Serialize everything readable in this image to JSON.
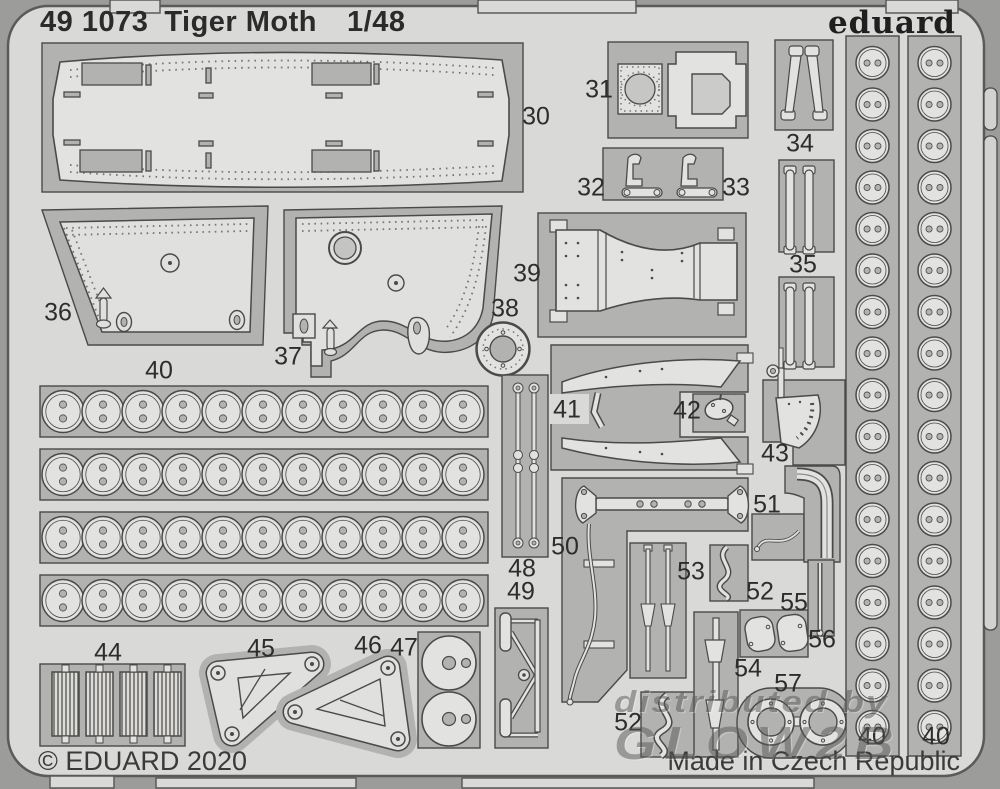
{
  "header": {
    "catalog_number": "49 1073",
    "product_title": "Tiger Moth",
    "scale": "1/48",
    "brand_logo": "eduard"
  },
  "footer": {
    "copyright": "© EDUARD 2020",
    "made_in": "Made in Czech Republic"
  },
  "watermark": {
    "line1": "distributed by",
    "line2": "GLOW2B"
  },
  "sheet": {
    "description": "Eduard photo-etched brass fret with numbered parts",
    "colors": {
      "background": "#9c9c9a",
      "fret": "#d9d9d7",
      "recess": "#b2b2b0",
      "part": "#e2e2e0",
      "outline": "#4a4a48"
    }
  },
  "part_labels": [
    {
      "number": "30",
      "x": 536,
      "y": 117
    },
    {
      "number": "31",
      "x": 599,
      "y": 90
    },
    {
      "number": "32",
      "x": 591,
      "y": 188
    },
    {
      "number": "33",
      "x": 736,
      "y": 188
    },
    {
      "number": "34",
      "x": 800,
      "y": 144
    },
    {
      "number": "35",
      "x": 803,
      "y": 265
    },
    {
      "number": "36",
      "x": 58,
      "y": 313
    },
    {
      "number": "37",
      "x": 288,
      "y": 357
    },
    {
      "number": "38",
      "x": 505,
      "y": 309
    },
    {
      "number": "39",
      "x": 527,
      "y": 274
    },
    {
      "number": "40",
      "x": 159,
      "y": 371
    },
    {
      "number": "41",
      "x": 567,
      "y": 410
    },
    {
      "number": "42",
      "x": 687,
      "y": 411
    },
    {
      "number": "43",
      "x": 775,
      "y": 454
    },
    {
      "number": "44",
      "x": 108,
      "y": 653
    },
    {
      "number": "45",
      "x": 261,
      "y": 649
    },
    {
      "number": "46",
      "x": 368,
      "y": 646
    },
    {
      "number": "47",
      "x": 404,
      "y": 648
    },
    {
      "number": "48",
      "x": 522,
      "y": 569
    },
    {
      "number": "49",
      "x": 521,
      "y": 592
    },
    {
      "number": "50",
      "x": 565,
      "y": 547
    },
    {
      "number": "51",
      "x": 767,
      "y": 505
    },
    {
      "number": "52",
      "x": 628,
      "y": 723
    },
    {
      "number": "52",
      "x": 760,
      "y": 592
    },
    {
      "number": "53",
      "x": 691,
      "y": 572
    },
    {
      "number": "54",
      "x": 748,
      "y": 669
    },
    {
      "number": "55",
      "x": 794,
      "y": 603
    },
    {
      "number": "56",
      "x": 822,
      "y": 640
    },
    {
      "number": "57",
      "x": 788,
      "y": 684
    },
    {
      "number": "40",
      "x": 872,
      "y": 737
    },
    {
      "number": "40",
      "x": 936,
      "y": 737
    }
  ]
}
